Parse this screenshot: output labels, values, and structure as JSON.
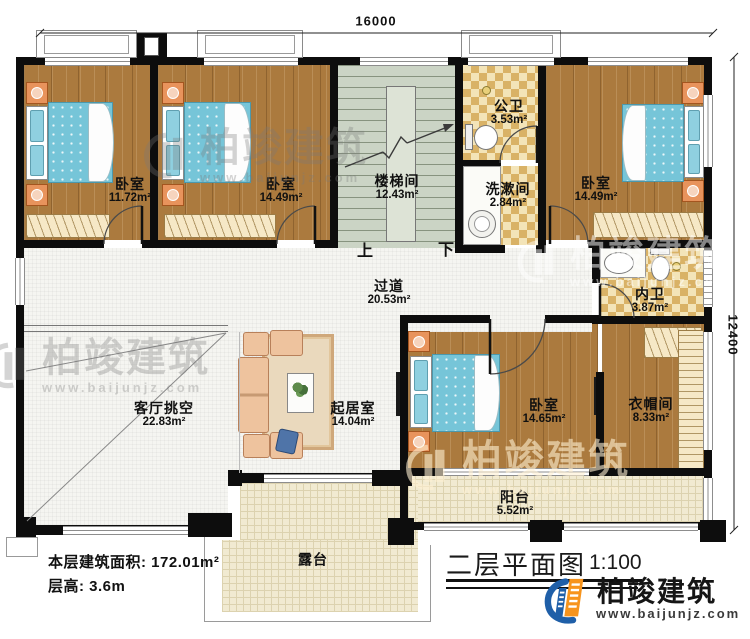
{
  "dimensions": {
    "top": "16000",
    "right": "12400"
  },
  "rooms": {
    "bedroom_tl": {
      "name": "卧室",
      "area": "11.72m²"
    },
    "bedroom_tm": {
      "name": "卧室",
      "area": "14.49m²"
    },
    "stairwell": {
      "name": "楼梯间",
      "area": "12.43m²"
    },
    "public_bath": {
      "name": "公卫",
      "area": "3.53m²"
    },
    "washroom": {
      "name": "洗漱间",
      "area": "2.84m²"
    },
    "bedroom_tr": {
      "name": "卧室",
      "area": "14.49m²"
    },
    "inner_bath": {
      "name": "内卫",
      "area": "3.87m²"
    },
    "corridor": {
      "name": "过道",
      "area": "20.53m²"
    },
    "living_void": {
      "name": "客厅挑空",
      "area": "22.83m²"
    },
    "sitting_room": {
      "name": "起居室",
      "area": "14.04m²"
    },
    "bedroom_b": {
      "name": "卧室",
      "area": "14.65m²"
    },
    "cloakroom": {
      "name": "衣帽间",
      "area": "8.33m²"
    },
    "balcony": {
      "name": "阳台",
      "area": "5.52m²"
    },
    "terrace": {
      "name": "露台"
    }
  },
  "stairs": {
    "up": "上",
    "down": "下"
  },
  "footer": {
    "area_label": "本层建筑面积:",
    "area_value": "172.01m²",
    "height_label": "层高:",
    "height_value": "3.6m"
  },
  "title_block": {
    "title": "二层平面图",
    "scale": "1:100"
  },
  "brand": {
    "name": "柏竣建筑",
    "url": "www.baijunjz.com"
  },
  "colors": {
    "brand_blue": "#1f5fa8",
    "brand_orange": "#f7941d",
    "wall": "#0d0d0d",
    "wood": "#ab7a3e"
  }
}
